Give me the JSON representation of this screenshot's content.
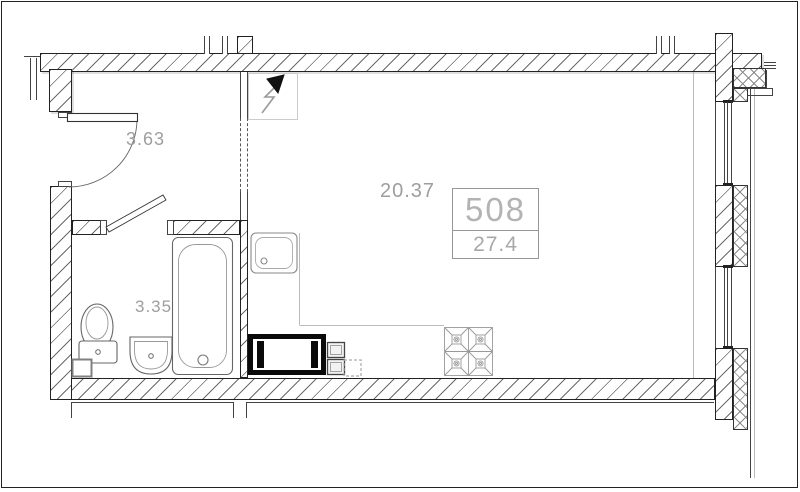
{
  "drawing": {
    "title": "Studio apartment floor plan",
    "unit_card": {
      "number": "508",
      "area": "27.4"
    },
    "rooms": {
      "hallway": {
        "label": "3.63"
      },
      "bathroom": {
        "label": "3.35"
      },
      "living": {
        "label": "20.37"
      }
    },
    "symbols": {
      "electric_panel": "electric-panel-arrow",
      "fixtures": [
        "toilet",
        "wash-basin",
        "bathtub",
        "kitchen-sink",
        "stove-4-burner",
        "washing-machine",
        "cabinet-modules",
        "planned-unit-dashed"
      ]
    },
    "colors": {
      "wall_line": "#222222",
      "hatch": "#6a6a6a",
      "fixture_line": "#666666",
      "counter_line": "#bbbbbb",
      "label_text": "#9e9e9e",
      "unit_text": "#b3b3b3",
      "appliance_black": "#0a0a0a"
    }
  }
}
